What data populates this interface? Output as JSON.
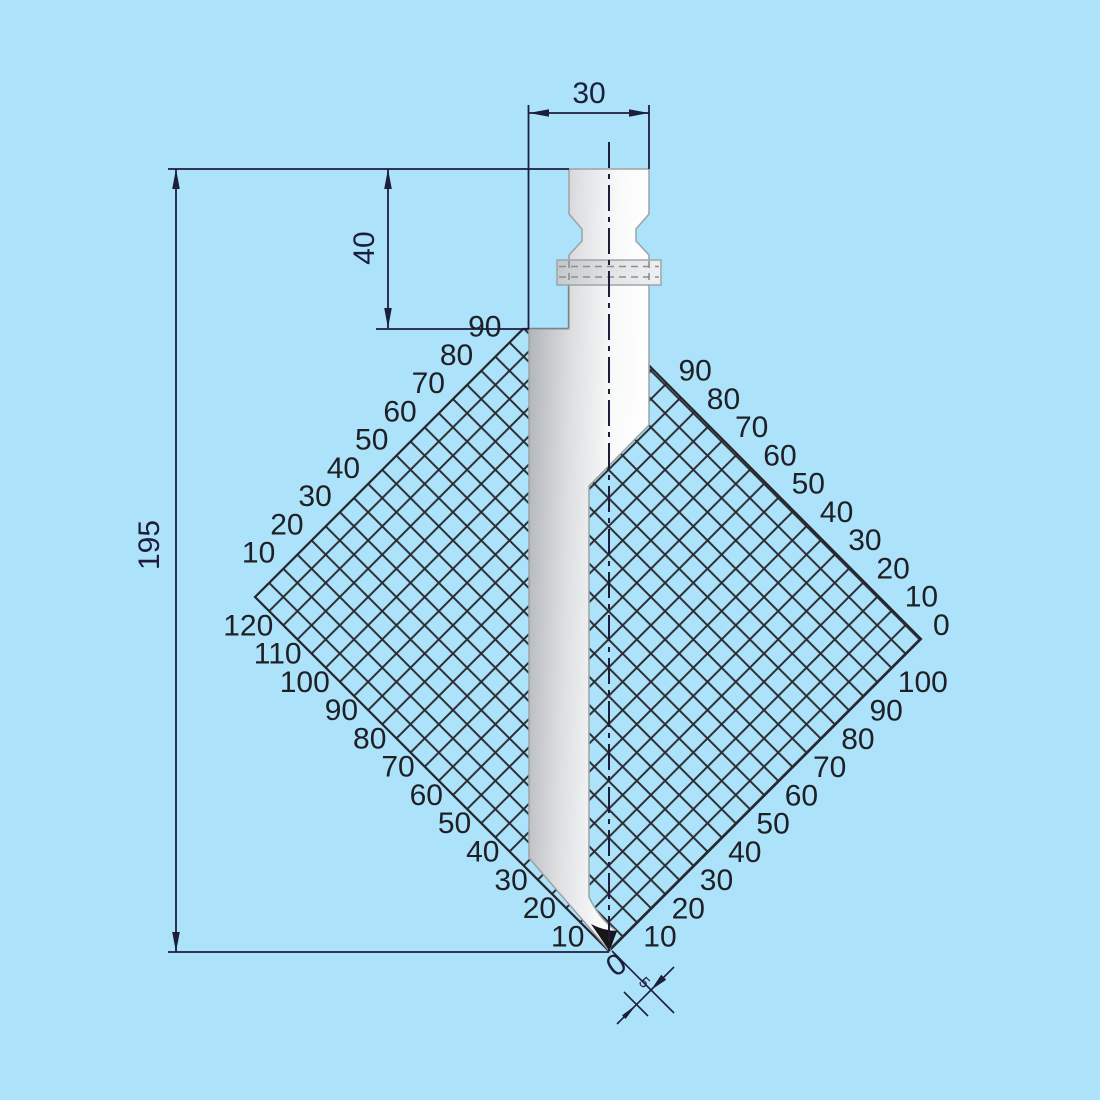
{
  "drawing": {
    "type": "press-brake-punch-technical-drawing",
    "colors": {
      "background": "#ace3fa",
      "grid_line": "#2b2b31",
      "grid_edge": "#26262e",
      "dim_color": "#1d1d3c",
      "tool_stroke": "#9ba2a7",
      "tip_color": "#17171a"
    },
    "dimensions": {
      "top_width": "30",
      "shank_height": "40",
      "total_height": "195",
      "tip_offset": "5",
      "tip_zero": "0"
    },
    "grid": {
      "corners": {
        "left": [
          255,
          597
        ],
        "top": [
          567,
          285
        ],
        "right": [
          921,
          639
        ],
        "bottom": [
          609,
          951
        ]
      },
      "label_step_px": 28.28,
      "upper_left_labels": [
        "10",
        "20",
        "30",
        "40",
        "50",
        "60",
        "70",
        "80",
        "90"
      ],
      "upper_right_labels": [
        "0",
        "10",
        "20",
        "30",
        "40",
        "50",
        "60",
        "70",
        "80",
        "90"
      ],
      "lower_left_labels": [
        "120",
        "110",
        "100",
        "90",
        "80",
        "70",
        "60",
        "50",
        "40",
        "30",
        "20",
        "10"
      ],
      "lower_right_labels": [
        "10",
        "20",
        "30",
        "40",
        "50",
        "60",
        "70",
        "80",
        "90",
        "100"
      ]
    }
  }
}
